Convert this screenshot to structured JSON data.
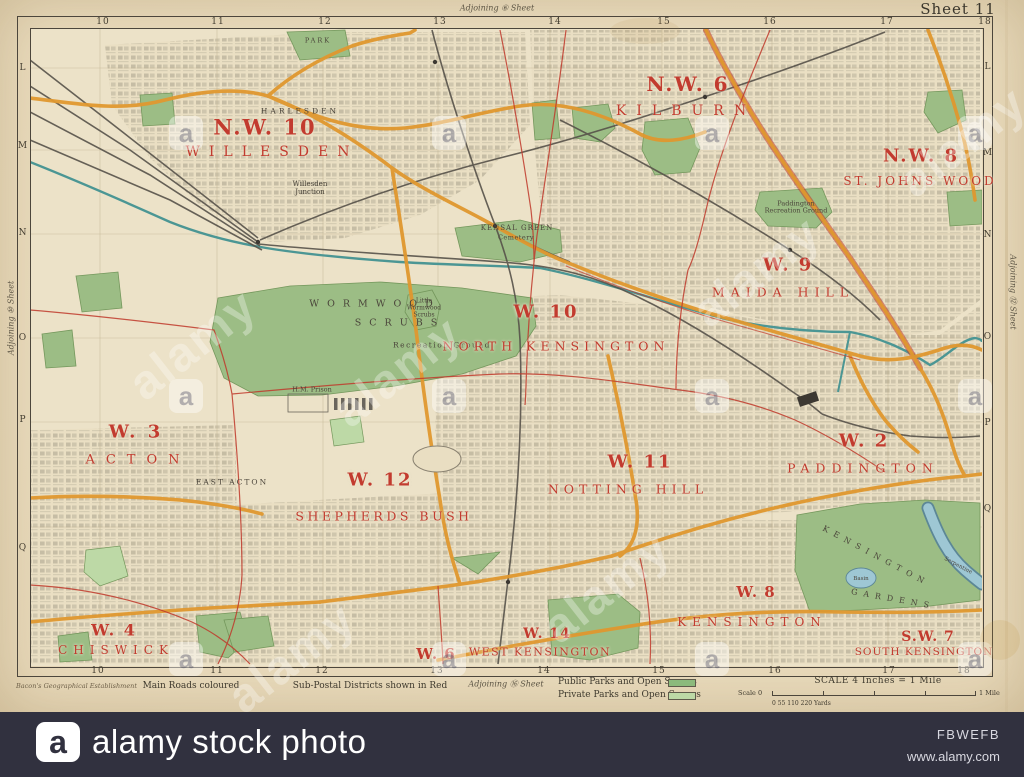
{
  "photo": {
    "watermark_text": "alamy",
    "logo_letter": "a",
    "bar": {
      "brand": "alamy stock photo",
      "image_id": "FBWEFB",
      "website": "www.alamy.com",
      "bg": "#31313f"
    }
  },
  "map": {
    "sheet_label": "Sheet 11",
    "adjoining": {
      "top": "Adjoining ⑥ Sheet",
      "bottom": "Adjoining ⑯ Sheet",
      "left": "Adjoining ⑩ Sheet",
      "right": "Adjoining ⑫ Sheet"
    },
    "grid": {
      "top": [
        {
          "n": "10",
          "x": 103,
          "y": 22
        },
        {
          "n": "11",
          "x": 218,
          "y": 22
        },
        {
          "n": "12",
          "x": 325,
          "y": 22
        },
        {
          "n": "13",
          "x": 440,
          "y": 22
        },
        {
          "n": "14",
          "x": 555,
          "y": 22
        },
        {
          "n": "15",
          "x": 664,
          "y": 22
        },
        {
          "n": "16",
          "x": 770,
          "y": 22
        },
        {
          "n": "17",
          "x": 887,
          "y": 22
        },
        {
          "n": "18",
          "x": 985,
          "y": 22
        }
      ],
      "bottom": [
        {
          "n": "10",
          "x": 98,
          "y": 671
        },
        {
          "n": "11",
          "x": 217,
          "y": 671
        },
        {
          "n": "12",
          "x": 322,
          "y": 671
        },
        {
          "n": "13",
          "x": 437,
          "y": 671
        },
        {
          "n": "14",
          "x": 544,
          "y": 671
        },
        {
          "n": "15",
          "x": 659,
          "y": 671
        },
        {
          "n": "16",
          "x": 775,
          "y": 671
        },
        {
          "n": "17",
          "x": 889,
          "y": 671
        },
        {
          "n": "18",
          "x": 964,
          "y": 671
        }
      ],
      "left": [
        {
          "n": "L",
          "x": 23,
          "y": 68
        },
        {
          "n": "M",
          "x": 23,
          "y": 146
        },
        {
          "n": "N",
          "x": 23,
          "y": 233
        },
        {
          "n": "O",
          "x": 23,
          "y": 338
        },
        {
          "n": "P",
          "x": 23,
          "y": 420
        },
        {
          "n": "Q",
          "x": 23,
          "y": 548
        }
      ],
      "right": [
        {
          "n": "L",
          "x": 988,
          "y": 67
        },
        {
          "n": "M",
          "x": 988,
          "y": 153
        },
        {
          "n": "N",
          "x": 988,
          "y": 235
        },
        {
          "n": "O",
          "x": 988,
          "y": 337
        },
        {
          "n": "P",
          "x": 988,
          "y": 423
        },
        {
          "n": "Q",
          "x": 988,
          "y": 509
        }
      ]
    },
    "districts": [
      {
        "code": "N.W. 10",
        "code_x": 265,
        "code_y": 127,
        "code_s": 21,
        "code_ls": 2,
        "name": "WILLESDEN",
        "name_x": 272,
        "name_y": 152,
        "name_s": 14,
        "name_ls": 9
      },
      {
        "code": "N.W. 6",
        "code_x": 688,
        "code_y": 84,
        "code_s": 20,
        "code_ls": 2,
        "name": "KILBURN",
        "name_x": 686,
        "name_y": 111,
        "name_s": 14,
        "name_ls": 10
      },
      {
        "code": "N.W. 8",
        "code_x": 921,
        "code_y": 156,
        "code_s": 18,
        "code_ls": 2,
        "name": "ST. JOHNS WOOD",
        "name_x": 920,
        "name_y": 181,
        "name_s": 12,
        "name_ls": 3
      },
      {
        "code": "W. 9",
        "code_x": 788,
        "code_y": 265,
        "code_s": 18,
        "code_ls": 2,
        "name": "MAIDA HILL",
        "name_x": 783,
        "name_y": 292,
        "name_s": 12.5,
        "name_ls": 6
      },
      {
        "code": "W. 10",
        "code_x": 546,
        "code_y": 312,
        "code_s": 18,
        "code_ls": 2,
        "name": "NORTH KENSINGTON",
        "name_x": 556,
        "name_y": 346,
        "name_s": 12.5,
        "name_ls": 5
      },
      {
        "code": "W. 3",
        "code_x": 136,
        "code_y": 432,
        "code_s": 18,
        "code_ls": 3,
        "name": "ACTON",
        "name_x": 138,
        "name_y": 460,
        "name_s": 13,
        "name_ls": 11
      },
      {
        "code": "W. 12",
        "code_x": 380,
        "code_y": 480,
        "code_s": 18,
        "code_ls": 2,
        "name": "SHEPHERDS BUSH",
        "name_x": 384,
        "name_y": 516,
        "name_s": 12.5,
        "name_ls": 3.5
      },
      {
        "code": "W. 11",
        "code_x": 640,
        "code_y": 462,
        "code_s": 18,
        "code_ls": 2,
        "name": "NOTTING HILL",
        "name_x": 628,
        "name_y": 489,
        "name_s": 12.5,
        "name_ls": 5
      },
      {
        "code": "W. 2",
        "code_x": 864,
        "code_y": 441,
        "code_s": 18,
        "code_ls": 2,
        "name": "PADDINGTON",
        "name_x": 863,
        "name_y": 468,
        "name_s": 12.5,
        "name_ls": 6
      },
      {
        "code": "W. 4",
        "code_x": 114,
        "code_y": 630,
        "code_s": 16,
        "code_ls": 2,
        "name": "CHISWICK",
        "name_x": 116,
        "name_y": 650,
        "name_s": 12,
        "name_ls": 6
      },
      {
        "code": "W. 6",
        "code_x": 436,
        "code_y": 654,
        "code_s": 15,
        "code_ls": 1,
        "name": "",
        "name_x": 436,
        "name_y": 664,
        "name_s": 8,
        "name_ls": 0
      },
      {
        "code": "W. 14",
        "code_x": 547,
        "code_y": 634,
        "code_s": 14,
        "code_ls": 1,
        "name": "WEST KENSINGTON",
        "name_x": 540,
        "name_y": 652,
        "name_s": 11,
        "name_ls": 1.5
      },
      {
        "code": "W. 8",
        "code_x": 756,
        "code_y": 592,
        "code_s": 15,
        "code_ls": 1,
        "name": "KENSINGTON",
        "name_x": 752,
        "name_y": 622,
        "name_s": 12,
        "name_ls": 6
      },
      {
        "code": "S.W. 7",
        "code_x": 928,
        "code_y": 637,
        "code_s": 14,
        "code_ls": 1,
        "name": "SOUTH KENSINGTON",
        "name_x": 924,
        "name_y": 652,
        "name_s": 10.5,
        "name_ls": 1
      }
    ],
    "places": [
      {
        "text": "PARK",
        "x": 318,
        "y": 41,
        "s": 6.5,
        "ls": 2
      },
      {
        "text": "HARLESDEN",
        "x": 300,
        "y": 112,
        "s": 7.5,
        "ls": 3
      },
      {
        "text": "Willesden Junction",
        "x": 310,
        "y": 188,
        "s": 7,
        "w": 58
      },
      {
        "text": "KENSAL GREEN",
        "x": 517,
        "y": 228,
        "s": 7,
        "ls": 1
      },
      {
        "text": "Cemetery",
        "x": 516,
        "y": 238,
        "s": 6.5,
        "ls": 0.5
      },
      {
        "text": "WORMWOOD",
        "x": 375,
        "y": 305,
        "s": 9.5,
        "ls": 8
      },
      {
        "text": "SCRUBS",
        "x": 400,
        "y": 324,
        "s": 9.5,
        "ls": 8
      },
      {
        "text": "Recreation Ground",
        "x": 442,
        "y": 346,
        "s": 7.5,
        "ls": 1.5
      },
      {
        "text": "Little Wormwood Scrubs",
        "x": 424,
        "y": 309,
        "s": 6,
        "w": 44
      },
      {
        "text": "H.M. Prison",
        "x": 312,
        "y": 390,
        "s": 6.5
      },
      {
        "text": "EAST ACTON",
        "x": 232,
        "y": 483,
        "s": 7.5,
        "ls": 2
      },
      {
        "text": "Paddington Recreation Ground",
        "x": 796,
        "y": 208,
        "s": 6.5,
        "w": 64
      },
      {
        "text": "KENSINGTON",
        "x": 876,
        "y": 556,
        "s": 8,
        "ls": 6,
        "rot": 28
      },
      {
        "text": "GARDENS",
        "x": 893,
        "y": 599,
        "s": 8,
        "ls": 6,
        "rot": 10
      },
      {
        "text": "Basin",
        "x": 861,
        "y": 579,
        "s": 5.5
      },
      {
        "text": "Serpentine",
        "x": 958,
        "y": 566,
        "s": 5.5,
        "rot": 28
      }
    ],
    "legend": {
      "credit": "Bacon's Geographical Establishment",
      "main_roads": "Main Roads coloured",
      "sub_postal": "Sub-Postal Districts shown in Red",
      "public_parks": "Public Parks and Open Spaces",
      "private_parks": "Private Parks and Open Spaces",
      "scale_title": "SCALE  4 Inches = 1 Mile",
      "scale_start": "Scale 0",
      "scale_end": "1 Mile",
      "scale_yards": "0  55 110    220 Yards",
      "public_swatch": "#8cba7c",
      "private_swatch": "#bdd9a6"
    },
    "colors": {
      "paper": "#e8d9ba",
      "map_base": "#ece2c8",
      "main_road": "#e0982f",
      "park": "#9cbd85",
      "private_park": "#bdd9a6",
      "water": "#4b9694",
      "boundary_red": "#c0392b",
      "district_red": "#c23b2f",
      "railway": "#57524a"
    }
  },
  "watermarks": {
    "texts": [
      {
        "x": 193,
        "y": 345
      },
      {
        "x": 398,
        "y": 372
      },
      {
        "x": 757,
        "y": 272
      },
      {
        "x": 292,
        "y": 658
      },
      {
        "x": 607,
        "y": 588
      },
      {
        "x": 963,
        "y": 142
      }
    ],
    "logos": [
      {
        "x": 186,
        "y": 133
      },
      {
        "x": 449,
        "y": 133
      },
      {
        "x": 712,
        "y": 133
      },
      {
        "x": 975,
        "y": 133
      },
      {
        "x": 186,
        "y": 396
      },
      {
        "x": 449,
        "y": 396
      },
      {
        "x": 712,
        "y": 396
      },
      {
        "x": 975,
        "y": 396
      },
      {
        "x": 186,
        "y": 659
      },
      {
        "x": 449,
        "y": 659
      },
      {
        "x": 712,
        "y": 659
      },
      {
        "x": 975,
        "y": 659
      }
    ]
  }
}
